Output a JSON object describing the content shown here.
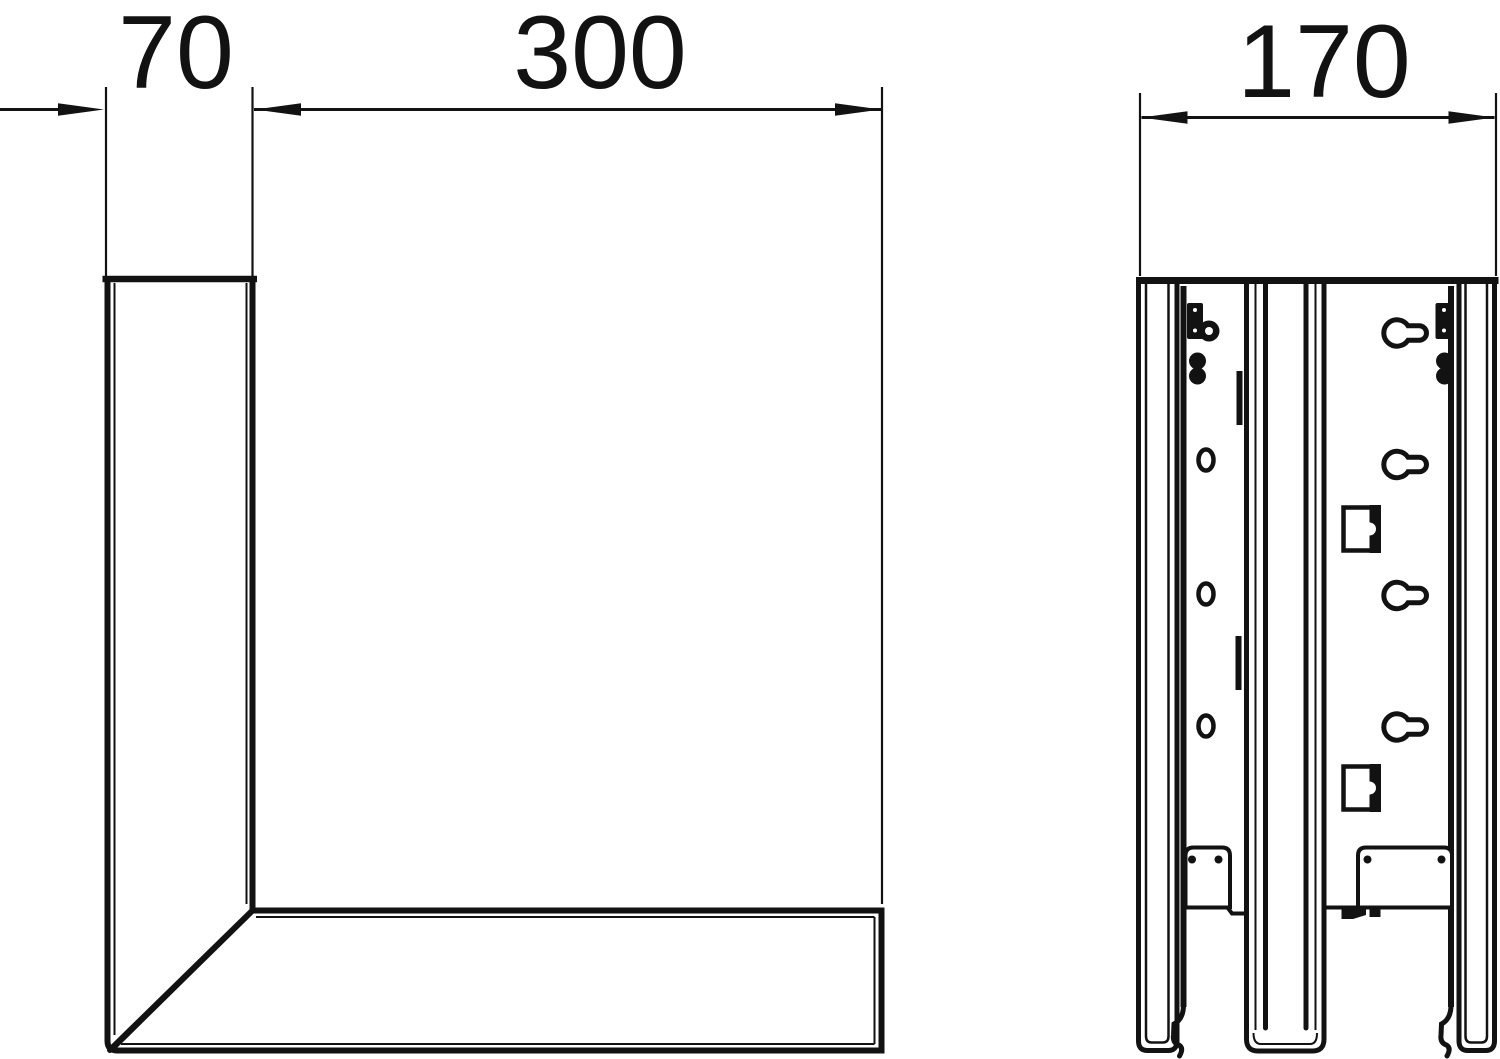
{
  "drawing": {
    "background": "#ffffff",
    "ink": "#121212",
    "dimensions": {
      "front_width": "70",
      "front_length": "300",
      "side_depth": "170"
    }
  }
}
